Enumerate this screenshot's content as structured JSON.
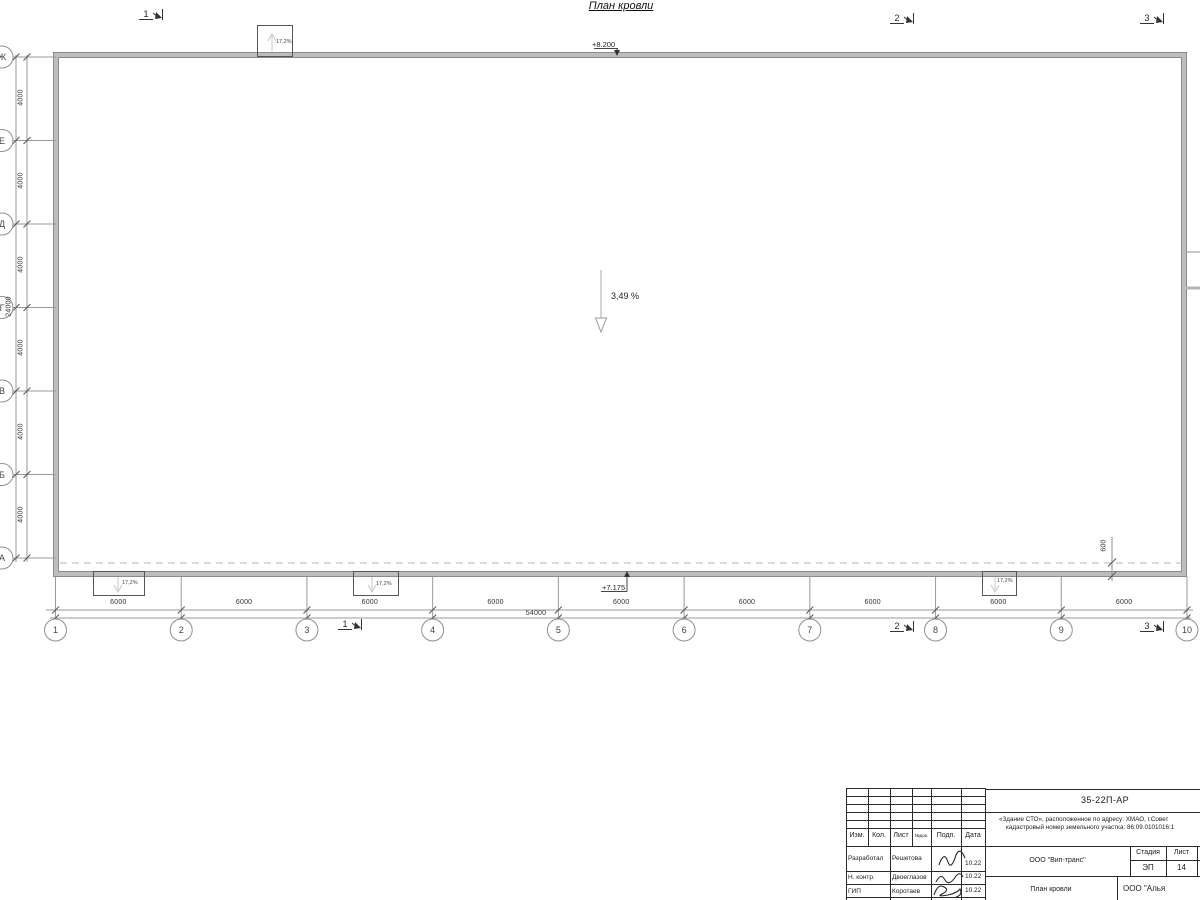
{
  "drawing": {
    "title": "План кровли",
    "elevation_top": "+8.200",
    "elevation_eave": "+7.175",
    "roof_slope": "3,49 %",
    "canopy_slope": "17,2%",
    "overhang": "600"
  },
  "axes": {
    "letters": [
      "Ж",
      "Е",
      "Д",
      "Г",
      "В",
      "Б",
      "А"
    ],
    "bay_vertical": "4000",
    "total_vertical": "24000",
    "numbers": [
      "1",
      "2",
      "3",
      "4",
      "5",
      "6",
      "7",
      "8",
      "9",
      "10"
    ],
    "bay_horizontal": "6000",
    "total_horizontal": "54000"
  },
  "section_markers": [
    "1",
    "2",
    "3"
  ],
  "title_block": {
    "doc_number": "35-22П-АР",
    "object_line1": "«Здание СТО», расположенное по адресу: ХМАО, г.Совет",
    "object_line2": "кадастровый номер земельного участка: 86:09.0101016:1",
    "header": {
      "izm": "Изм.",
      "kol": "Кол.",
      "list": "Лист",
      "ndok": "№док.",
      "podp": "Подп.",
      "data": "Дата"
    },
    "rows": [
      {
        "role": "Разработал",
        "name": "Решетова",
        "date": "10.22"
      },
      {
        "role": "Н. контр.",
        "name": "Двоеглазов",
        "date": "10.22"
      },
      {
        "role": "ГИП",
        "name": "Коротаев",
        "date": "10.22"
      }
    ],
    "company": "ООО \"Вип-транс\"",
    "stage_label": "Стадия",
    "sheet_label": "Лист",
    "sheets_label": "Листов",
    "stage": "ЭП",
    "sheet_number": "14",
    "sheet_title": "План кровли",
    "org": "ООО \"Алья"
  }
}
